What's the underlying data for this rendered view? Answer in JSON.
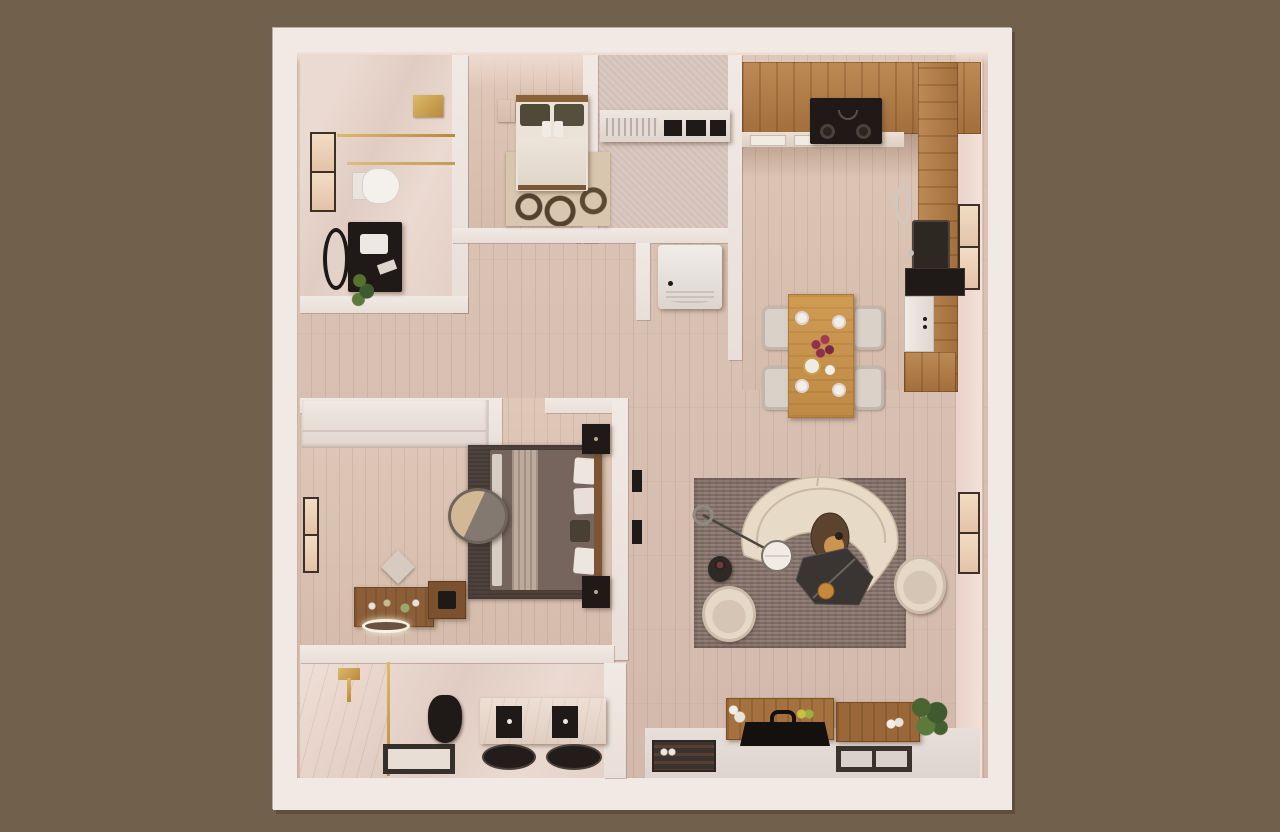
{
  "scene": {
    "title": "apartment-floor-plan-3d-render",
    "view": "top-down dollhouse render",
    "no_visible_text": true
  },
  "palette": {
    "bg": "#71614C",
    "wallWhite": "#F1E9E4",
    "wallFace": "#EFDCD4",
    "floorWood": "#D8C0B2",
    "floorMarble": "#E7D8D0",
    "kitchenWood": "#B07E4E",
    "tableWood": "#C9964F",
    "consoleWood": "#A5713F",
    "rugLiving": "#8C7A72",
    "rugMaster": "#4E423D",
    "mosaicBase": "#D8C7AE",
    "mosaicDark": "#54422F",
    "sofaCream": "#E7DAC7",
    "marbleTable": "#3A3533",
    "gold": "#C89F4C",
    "black": "#1F1A17",
    "white": "#F2EEEA",
    "plantGreen": "#4A652F",
    "windowFrame": "#3C3027",
    "entryFloor": "#E3DAD5"
  },
  "rooms": [
    {
      "id": "bathroom-top-left",
      "name": "guest bathroom",
      "furniture": [
        "walk-in shower with gold fixture",
        "gold glass partition rail",
        "window",
        "white toilet",
        "dark vanity with basin",
        "round black mirror",
        "potted plant"
      ]
    },
    {
      "id": "bedroom-small",
      "name": "second bedroom",
      "furniture": [
        "double bed with olive pillows",
        "wood headboard",
        "wood nightstand",
        "mosaic circle rug",
        "foot bench"
      ]
    },
    {
      "id": "laundry-closet",
      "name": "utility closet",
      "furniture": [
        "built-in counter with appliance fronts",
        "vent grille",
        "washing machine"
      ]
    },
    {
      "id": "kitchen",
      "name": "kitchen",
      "furniture": [
        "L-shaped wood cabinets",
        "black cooktop with hood",
        "counter modules",
        "black basin sink",
        "window",
        "wall oven",
        "white dishwasher",
        "lower cabinets",
        "metal dish"
      ]
    },
    {
      "id": "dining-area",
      "name": "dining area",
      "furniture": [
        "wood dining table",
        "four upholstered chairs",
        "four place settings",
        "flower vase"
      ]
    },
    {
      "id": "living-room",
      "name": "living room",
      "furniture": [
        "large area rug",
        "curved cream sectional sofa",
        "arc floor lamp",
        "round leather ottoman",
        "sculptural dark marble coffee table",
        "gold bowl",
        "small side table",
        "two cream accent chairs",
        "window"
      ]
    },
    {
      "id": "hallway",
      "name": "hallway",
      "furniture": [
        "two wall art pieces"
      ]
    },
    {
      "id": "bedroom-master",
      "name": "master bedroom",
      "furniture": [
        "double bed with throw blanket",
        "two dark nightstands",
        "dark area rug",
        "papasan lounge chair",
        "floor pouf",
        "two wood dressers",
        "lit round tray",
        "window",
        "built-in white wardrobe"
      ]
    },
    {
      "id": "bathroom-master",
      "name": "master bathroom",
      "furniture": [
        "marble shower with gold set",
        "gold-framed glass panel",
        "framed shower tray",
        "black toilet",
        "marble double vanity",
        "two black vessel sinks"
      ]
    },
    {
      "id": "entry-media",
      "name": "entry / media wall",
      "furniture": [
        "two wood TV consoles",
        "flat TV with handle",
        "white vases",
        "lemons",
        "white decor",
        "houseplant",
        "dark doormat with shoes",
        "framed doormat"
      ]
    }
  ]
}
